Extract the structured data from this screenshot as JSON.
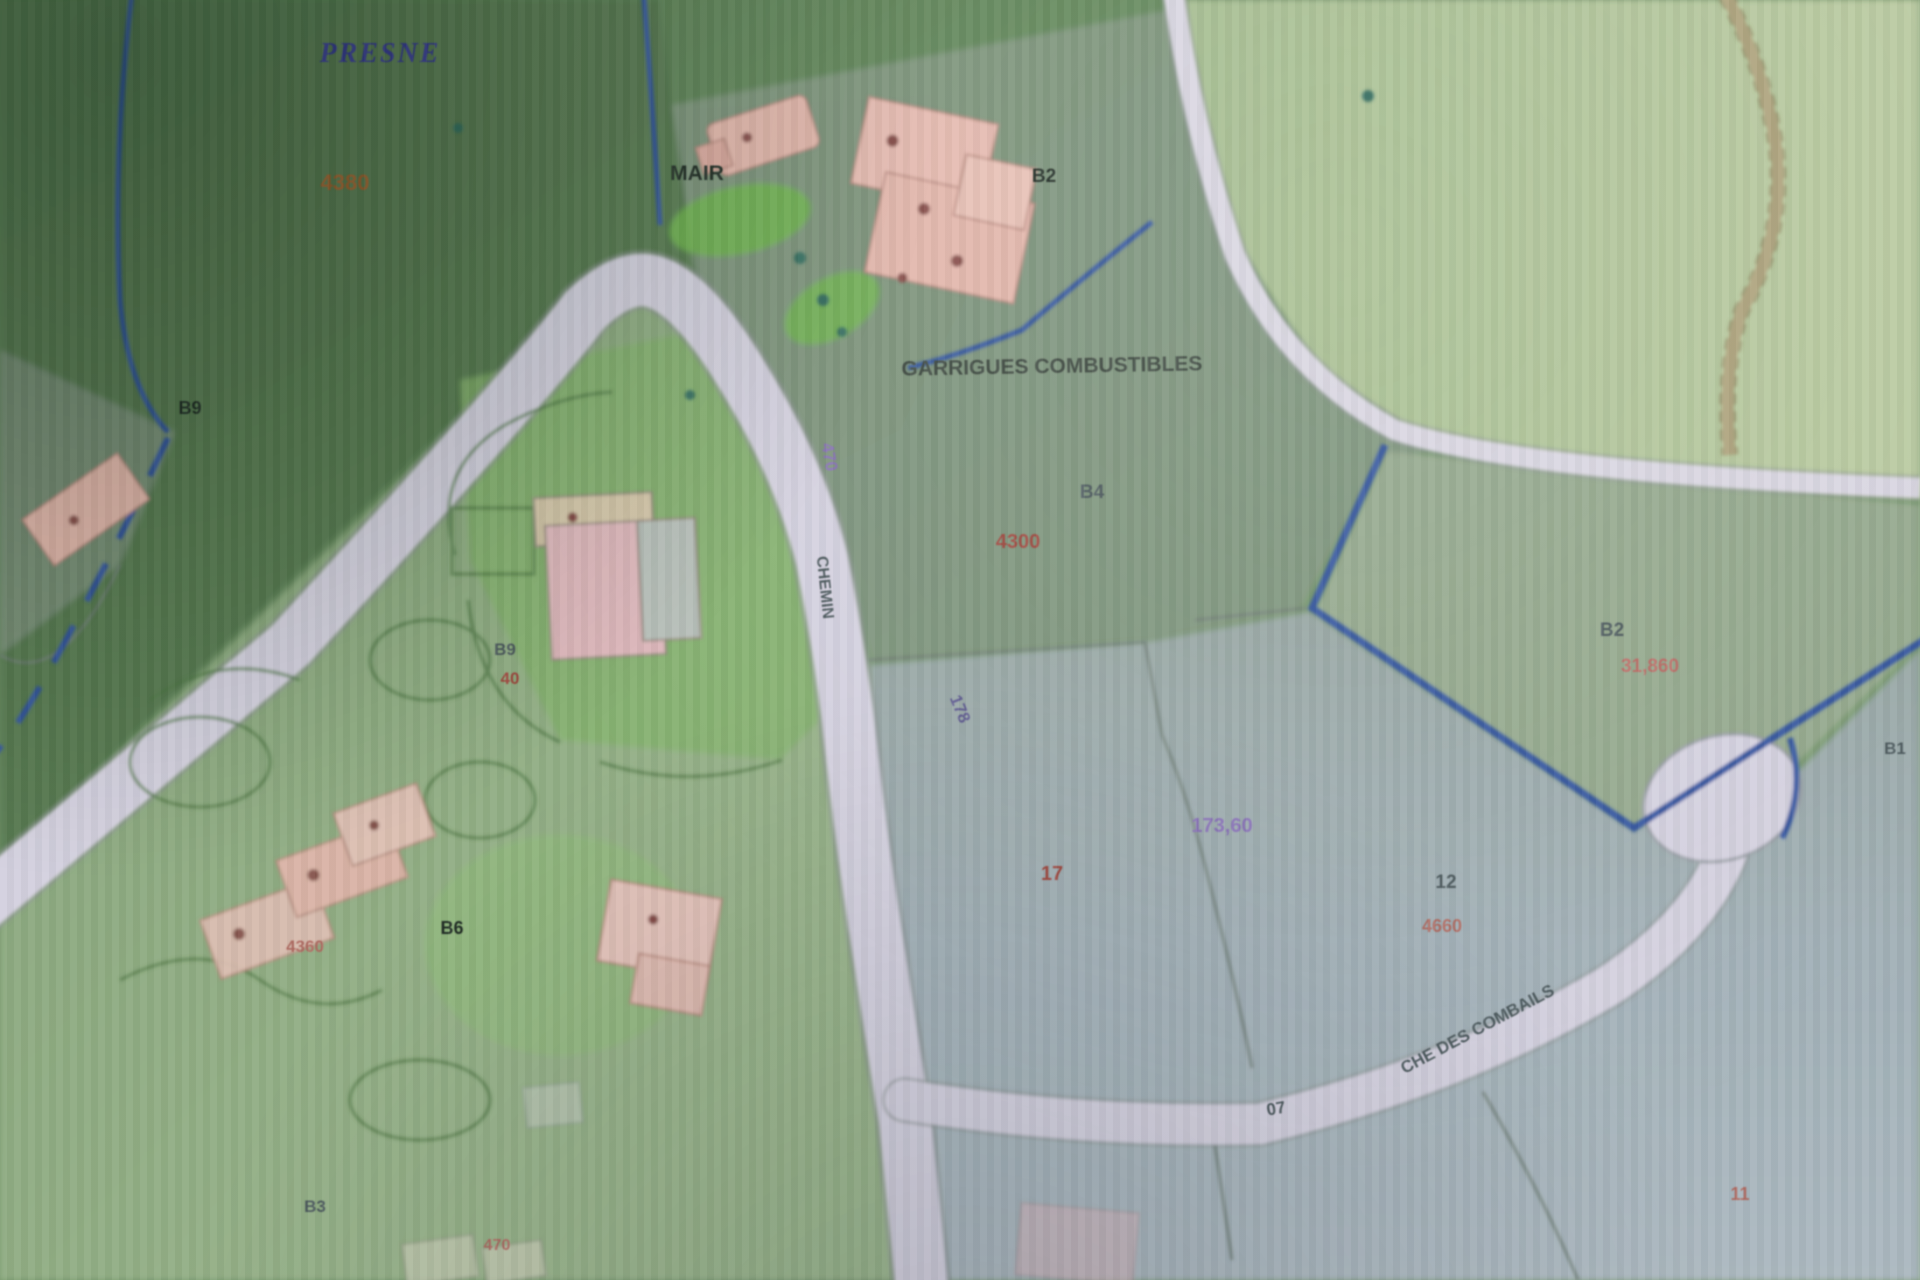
{
  "map": {
    "kind": "cadastral-parcel-map-photo",
    "colors": {
      "dark_green_area": "#54794d",
      "sage_area": "#7e977c",
      "light_green_parcel": "#aec594",
      "grey_blue_parcel": "#a3b3b8",
      "pale_green_area": "#96b586",
      "road_fill": "#d8d4e4",
      "road_edge": "#8e9896",
      "water_blue": "#2f55a8",
      "building_pink": "#e9b7ab",
      "hedge_green": "#4e7a42",
      "track_tan": "#b0a478",
      "parcel_number_red": "#a8453a",
      "place_name_blue": "#34379b"
    },
    "labels": [
      {
        "key": "place-name",
        "text": "PRESNE",
        "x": 380,
        "y": 62,
        "size": 28,
        "rot": 0,
        "cls": "c-blue serifital"
      },
      {
        "key": "area-number-topleft",
        "text": "4380",
        "x": 345,
        "y": 190,
        "size": 22,
        "rot": 0,
        "cls": "c-orange"
      },
      {
        "key": "mairie-abbrev",
        "text": "MAIR",
        "x": 697,
        "y": 180,
        "size": 21,
        "rot": 0,
        "cls": "c-dark"
      },
      {
        "key": "parcel-b2-top",
        "text": "B2",
        "x": 1044,
        "y": 182,
        "size": 19,
        "rot": 0,
        "cls": "c-dark"
      },
      {
        "key": "lieu-dit",
        "text": "GARRIGUES COMBUSTIBLES",
        "x": 1052,
        "y": 373,
        "size": 21,
        "rot": -1,
        "cls": "c-darkgrey"
      },
      {
        "key": "parcel-b4",
        "text": "B4",
        "x": 1092,
        "y": 498,
        "size": 19,
        "rot": 0,
        "cls": "c-slate"
      },
      {
        "key": "area-4300",
        "text": "4300",
        "x": 1018,
        "y": 548,
        "size": 20,
        "rot": 0,
        "cls": "c-red"
      },
      {
        "key": "parcel-b9-left",
        "text": "B9",
        "x": 190,
        "y": 414,
        "size": 18,
        "rot": 0,
        "cls": "c-dark"
      },
      {
        "key": "parcel-b9-center",
        "text": "B9",
        "x": 505,
        "y": 655,
        "size": 17,
        "rot": 0,
        "cls": "c-slate"
      },
      {
        "key": "area-40",
        "text": "40",
        "x": 510,
        "y": 684,
        "size": 17,
        "rot": 0,
        "cls": "c-red"
      },
      {
        "key": "road-number-470",
        "text": "470",
        "x": 824,
        "y": 458,
        "size": 17,
        "rot": 80,
        "cls": "c-purple"
      },
      {
        "key": "road-name-chemin",
        "text": "CHEMIN",
        "x": 820,
        "y": 588,
        "size": 16,
        "rot": 84,
        "cls": "c-slate"
      },
      {
        "key": "area-178",
        "text": "178",
        "x": 955,
        "y": 711,
        "size": 17,
        "rot": 68,
        "cls": "c-purpledark"
      },
      {
        "key": "measure-17360",
        "text": "173,60",
        "x": 1222,
        "y": 832,
        "size": 20,
        "rot": 0,
        "cls": "c-purple"
      },
      {
        "key": "parcel-17",
        "text": "17",
        "x": 1052,
        "y": 880,
        "size": 20,
        "rot": 0,
        "cls": "c-red"
      },
      {
        "key": "parcel-12",
        "text": "12",
        "x": 1446,
        "y": 888,
        "size": 19,
        "rot": 0,
        "cls": "c-slate"
      },
      {
        "key": "area-4660",
        "text": "4660",
        "x": 1442,
        "y": 932,
        "size": 18,
        "rot": 0,
        "cls": "c-redfaint"
      },
      {
        "key": "parcel-b2-right",
        "text": "B2",
        "x": 1612,
        "y": 636,
        "size": 19,
        "rot": 0,
        "cls": "c-slate"
      },
      {
        "key": "area-31860",
        "text": "31,860",
        "x": 1650,
        "y": 672,
        "size": 19,
        "rot": 0,
        "cls": "c-redpink"
      },
      {
        "key": "parcel-b6",
        "text": "B6",
        "x": 452,
        "y": 934,
        "size": 18,
        "rot": 0,
        "cls": "c-dark"
      },
      {
        "key": "area-4360",
        "text": "4360",
        "x": 305,
        "y": 952,
        "size": 17,
        "rot": 0,
        "cls": "c-redfaint"
      },
      {
        "key": "parcel-b3",
        "text": "B3",
        "x": 315,
        "y": 1212,
        "size": 17,
        "rot": 0,
        "cls": "c-slate"
      },
      {
        "key": "area-470-bottom",
        "text": "470",
        "x": 497,
        "y": 1250,
        "size": 16,
        "rot": 0,
        "cls": "c-redfaint"
      },
      {
        "key": "road-number-07",
        "text": "07",
        "x": 1277,
        "y": 1114,
        "size": 17,
        "rot": -10,
        "cls": "c-slate"
      },
      {
        "key": "road-name-combails",
        "text": "CHE DES COMBAILS",
        "x": 1480,
        "y": 1034,
        "size": 17,
        "rot": -28,
        "cls": "c-slate"
      },
      {
        "key": "parcel-11",
        "text": "11",
        "x": 1740,
        "y": 1200,
        "size": 18,
        "rot": 0,
        "cls": "c-redfaint"
      },
      {
        "key": "parcel-b1",
        "text": "B1",
        "x": 1895,
        "y": 754,
        "size": 17,
        "rot": 0,
        "cls": "c-slate"
      }
    ]
  }
}
